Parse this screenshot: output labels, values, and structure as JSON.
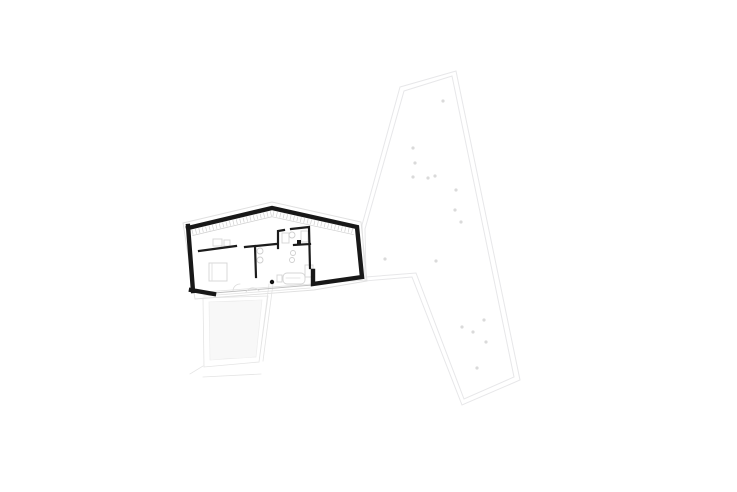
{
  "canvas": {
    "width": 737,
    "height": 492,
    "background": "#ffffff"
  },
  "colors": {
    "wall_black": "#181818",
    "interior_wall": "#1c1c1c",
    "site_line": "#e7e7e9",
    "tree_dot": "#dadada",
    "furniture_line": "#d4d4d4",
    "hatch_line": "#ededed",
    "overhang_line": "#e0e0e0",
    "glazing_line": "#bbbbbb"
  },
  "drawing": {
    "width": 737,
    "height": 492,
    "layers": [
      {
        "name": "site-boundary-outer",
        "type": "path",
        "d": "M400 87 L456 71 L520 380 L462 405 L412 277 L365 281 L362 225 Z",
        "stroke": "#e7e7e9",
        "width": 1
      },
      {
        "name": "site-boundary-inner",
        "type": "path",
        "d": "M404 91 L452 76 L514 377 L464 399 L416 273 L366 277 L365 229 Z",
        "stroke": "#e7e7e9",
        "width": 1
      },
      {
        "name": "tree-dots",
        "type": "dots",
        "r": 1.6,
        "fill": "#dadada",
        "points": [
          [
            443,
            101
          ],
          [
            413,
            148
          ],
          [
            415,
            163
          ],
          [
            413,
            177
          ],
          [
            428,
            178
          ],
          [
            435,
            176
          ],
          [
            456,
            190
          ],
          [
            455,
            210
          ],
          [
            461,
            222
          ],
          [
            385,
            259
          ],
          [
            436,
            261
          ],
          [
            484,
            320
          ],
          [
            462,
            327
          ],
          [
            473,
            332
          ],
          [
            486,
            342
          ],
          [
            477,
            368
          ]
        ]
      },
      {
        "name": "terrace-deck-hatch",
        "type": "hatch",
        "points": [
          [
            209,
            302
          ],
          [
            262,
            300
          ],
          [
            256,
            357
          ],
          [
            210,
            360
          ]
        ],
        "spacing": 2,
        "stroke": "#ededed",
        "width": 0.7
      },
      {
        "name": "terrace-outline",
        "type": "path",
        "d": "M203 298 L268 296 L259 362 L204 367 Z M269 284 L259 362 M273 284 L263 361 M203 377 L261 374 M190 374 L203 366",
        "stroke": "#e4e4e4",
        "width": 0.8
      },
      {
        "name": "path-edge-lines",
        "type": "path",
        "d": "M204 292 L366 280 M204 296 L310 288",
        "stroke": "#e2e2e2",
        "width": 0.8
      },
      {
        "name": "roof-overhang-outline",
        "type": "path",
        "d": "M183 223 L272 202 L361 222 L367 281 L314 290 L195 299 Z",
        "stroke": "#e0e0e0",
        "width": 0.9
      },
      {
        "name": "glass-wall-line",
        "type": "path",
        "d": "M214 293 L313 285",
        "stroke": "#bbbbbb",
        "width": 0.9
      },
      {
        "name": "furniture-rects",
        "type": "rects",
        "stroke": "#d4d4d4",
        "fill": "none",
        "width": 0.9,
        "items": [
          [
            209,
            263,
            18,
            18,
            0
          ],
          [
            213,
            239,
            9,
            7,
            0
          ],
          [
            224,
            240,
            6,
            6,
            0
          ],
          [
            301,
            231,
            7,
            11,
            0
          ],
          [
            305,
            265,
            8,
            12,
            0
          ],
          [
            282,
            233,
            7,
            10,
            0
          ],
          [
            283,
            273,
            22,
            11,
            4
          ],
          [
            277,
            275,
            5,
            7,
            0
          ]
        ]
      },
      {
        "name": "fixture-circles",
        "type": "circles",
        "stroke": "#cfcfcf",
        "width": 0.9,
        "items": [
          [
            292,
            235,
            3
          ],
          [
            293,
            253,
            2.5
          ],
          [
            292,
            260,
            2.5
          ],
          [
            260,
            251,
            3
          ],
          [
            260,
            260,
            3
          ]
        ]
      },
      {
        "name": "furniture-detail-lines",
        "type": "path",
        "d": "M212 264 L212 280 M233 291 A7 7 0 0 1 240 284 M246 292 Q252 284 259 291 M286 278 L300 278",
        "stroke": "#dcdcdc",
        "width": 0.8
      },
      {
        "name": "cladding-ticks",
        "type": "ticks",
        "len": 5,
        "spacing": 3.5,
        "stroke": "#cfcfcf",
        "segments": [
          {
            "from": [
              191,
              230
            ],
            "to": [
              271,
              211
            ]
          },
          {
            "from": [
              273,
              211
            ],
            "to": [
              355,
              229
            ]
          }
        ]
      },
      {
        "name": "interior-walls",
        "type": "path",
        "d": "M199 251 L236 246 M245 247 L255 246 L256 277 M256 246 L276 244 M278 248 L278 231 L284 230 M291 229 L309 227 L310 268 M294 245 L310 244",
        "stroke": "#1c1c1c",
        "width": 2.2
      },
      {
        "name": "building-outer-walls",
        "type": "path",
        "d": "M188 228 L272 208 L357 227 L362 277 L313 284 L313 271 M188 226 L193 291 M191 290 L214 294",
        "stroke": "#181818",
        "width": 4.4
      },
      {
        "name": "wall-fixture-block",
        "type": "rects",
        "fill": "#181818",
        "stroke": "none",
        "width": 0,
        "items": [
          [
            297,
            240,
            4,
            4,
            0
          ]
        ]
      },
      {
        "name": "column-dot",
        "type": "dots",
        "r": 2.2,
        "fill": "#111111",
        "points": [
          [
            272,
            282
          ]
        ]
      }
    ]
  }
}
